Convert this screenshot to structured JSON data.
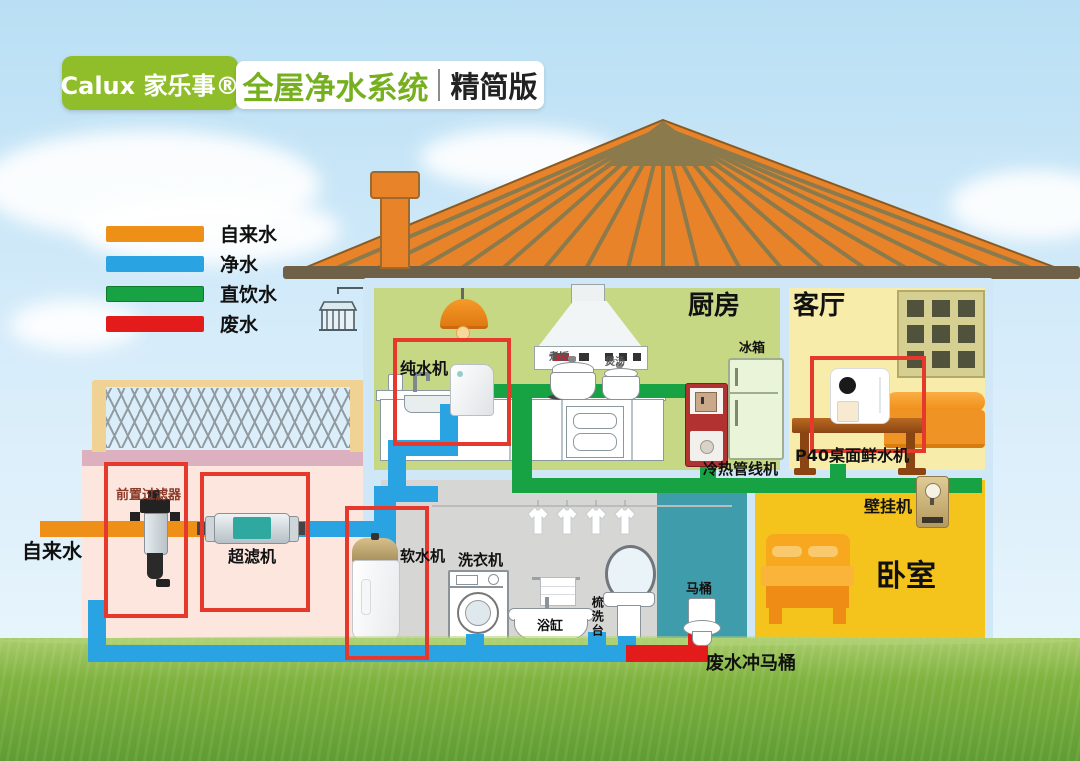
{
  "header": {
    "logo_text": "Calux 家乐事®",
    "title": "全屋净水系统",
    "edition": "精简版"
  },
  "legend": {
    "items": [
      {
        "label": "自来水",
        "color": "#ee9018"
      },
      {
        "label": "净水",
        "color": "#29a3e2"
      },
      {
        "label": "直饮水",
        "color": "#17a244"
      },
      {
        "label": "废水",
        "color": "#e41b1b"
      }
    ]
  },
  "rooms": {
    "kitchen": "厨房",
    "living_room": "客厅",
    "bedroom": "卧室"
  },
  "labels": {
    "tap_water": "自来水",
    "prefilter": "前置过滤器",
    "ultrafilter": "超滤机",
    "softener": "软水机",
    "pure_water_machine": "纯水机",
    "washing_machine": "洗衣机",
    "bathtub": "浴缸",
    "vanity": "梳洗台",
    "toilet": "马桶",
    "fridge": "冰箱",
    "pipeline_machine": "冷热管线机",
    "p40_machine": "P40桌面鲜水机",
    "wall_mounted_machine": "壁挂机",
    "waste_flush_toilet": "废水冲马桶",
    "pot_rice": "煮饭",
    "pot_soup": "煲汤"
  },
  "colors": {
    "pipe_tap": "#ee9018",
    "pipe_clean": "#29a3e2",
    "pipe_drink": "#17a244",
    "pipe_waste": "#e41b1b",
    "highlight_box": "#e6392e",
    "brand_green": "#8fbe2a",
    "title_green": "#76b01e",
    "roof": "#e8832a",
    "kitchen_wall": "#c6d883",
    "living_wall": "#f8ecaa",
    "bedroom_wall": "#f4c31c",
    "bathroom_wall": "#d6d6d4",
    "toilet_room": "#3f9dab",
    "basement": "#fce6dd"
  }
}
